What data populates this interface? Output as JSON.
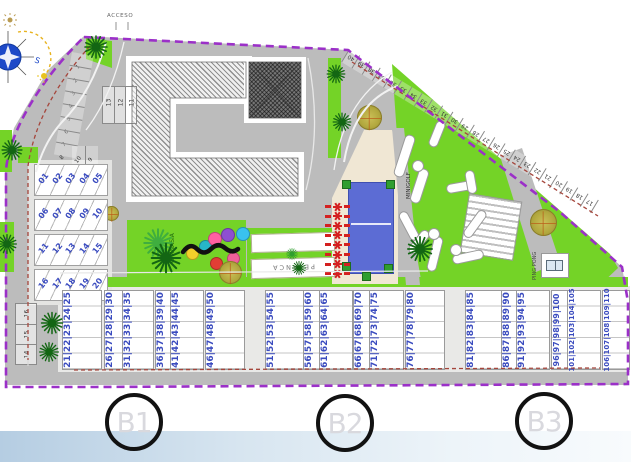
{
  "entrance_label": "ACCESO",
  "compass": {
    "south_label": "S"
  },
  "area_labels": {
    "playground": "GIMNASIA",
    "petanca": "PETANCA",
    "minigolf": "MINIGOLF",
    "ping_pong": "PING PONG"
  },
  "section_markers": [
    "B1",
    "B2",
    "B3"
  ],
  "parking": {
    "curve_stalls": [
      "1",
      "2",
      "3",
      "4",
      "5",
      "6",
      "7",
      "8"
    ],
    "pair_stalls": [
      "10",
      "9"
    ],
    "row_stalls": [
      "13",
      "12",
      "11"
    ],
    "left_stalls": [
      "16",
      "15",
      "14"
    ],
    "diagonal_stalls": [
      "40",
      "39",
      "38",
      "37",
      "36",
      "35",
      "34",
      "33",
      "32",
      "31",
      "30",
      "29",
      "28",
      "27",
      "26",
      "25",
      "24",
      "23",
      "22",
      "21",
      "20",
      "19",
      "18",
      "17"
    ]
  },
  "housing": {
    "left_rows": [
      [
        "01",
        "02",
        "03",
        "04",
        "05"
      ],
      [
        "06",
        "07",
        "08",
        "09",
        "10"
      ],
      [
        "11",
        "12",
        "13",
        "14",
        "15"
      ],
      [
        "16",
        "17",
        "18",
        "19",
        "20"
      ]
    ],
    "bottom_blocks": [
      [
        "21",
        "22",
        "23",
        "24",
        "25"
      ],
      [
        "26",
        "27",
        "28",
        "29",
        "30"
      ],
      [
        "31",
        "32",
        "33",
        "34",
        "35"
      ],
      [
        "36",
        "37",
        "38",
        "39",
        "40"
      ],
      [
        "41",
        "42",
        "43",
        "44",
        "45"
      ],
      [
        "46",
        "47",
        "48",
        "49",
        "50"
      ],
      [
        "51",
        "52",
        "53",
        "54",
        "55"
      ],
      [
        "56",
        "57",
        "58",
        "59",
        "60"
      ],
      [
        "61",
        "62",
        "63",
        "64",
        "65"
      ],
      [
        "66",
        "67",
        "68",
        "69",
        "70"
      ],
      [
        "71",
        "72",
        "73",
        "74",
        "75"
      ],
      [
        "76",
        "77",
        "78",
        "79",
        "80"
      ],
      [
        "81",
        "82",
        "83",
        "84",
        "85"
      ],
      [
        "86",
        "87",
        "88",
        "89",
        "90"
      ],
      [
        "91",
        "92",
        "93",
        "94",
        "95"
      ],
      [
        "96",
        "97",
        "98",
        "99",
        "100"
      ],
      [
        "101",
        "102",
        "103",
        "104",
        "105"
      ],
      [
        "106",
        "107",
        "108",
        "109",
        "110"
      ]
    ]
  },
  "colors": {
    "boundary": "#9b30c8",
    "parcel_line": "#a5463c",
    "green": "#74d327",
    "pool": "#5c6cd4",
    "deck": "#f0e7d4",
    "road": "#bcbcbc",
    "unit_number": "#3a4bbf",
    "lounger": "#d42020",
    "palm": "#136613"
  }
}
